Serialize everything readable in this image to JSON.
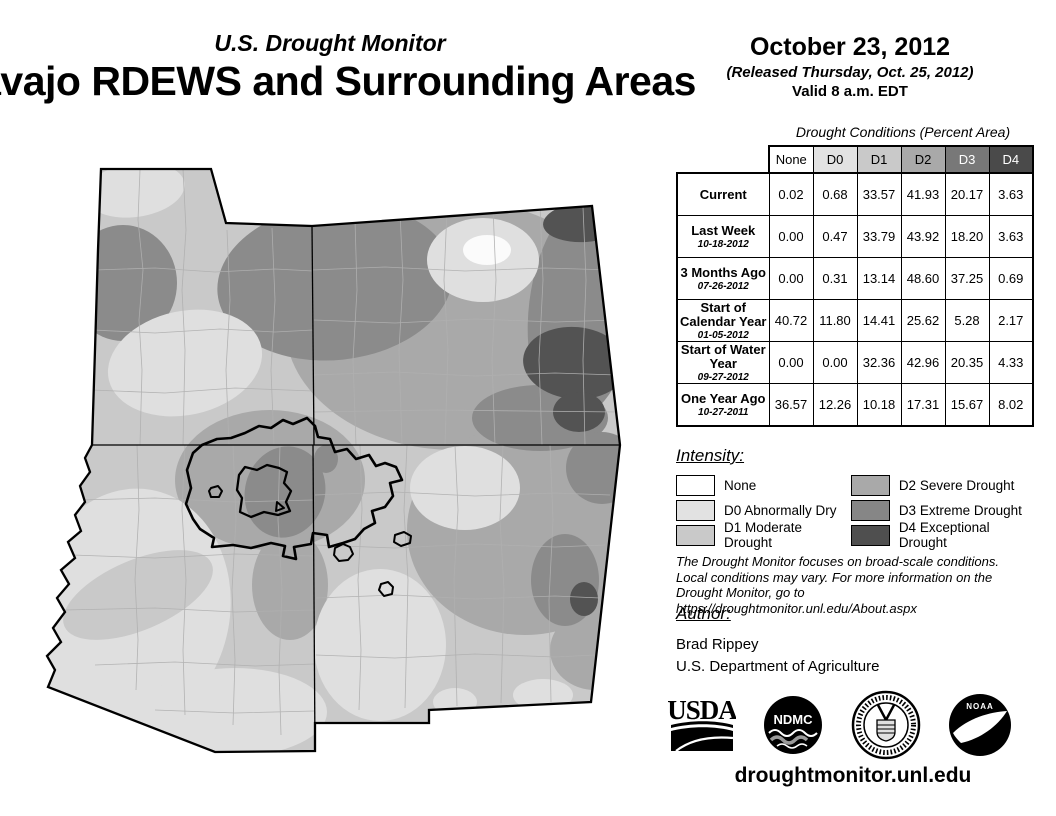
{
  "header": {
    "program": "U.S. Drought Monitor",
    "region_title": "Navajo RDEWS and Surrounding Areas",
    "date": "October 23, 2012",
    "released": "(Released Thursday, Oct. 25, 2012)",
    "valid": "Valid 8 a.m. EDT"
  },
  "table": {
    "title": "Drought Conditions (Percent Area)",
    "columns": [
      "None",
      "D0",
      "D1",
      "D2",
      "D3",
      "D4"
    ],
    "column_colors": {
      "None": "#ffffff",
      "D0": "#e2e2e2",
      "D1": "#c9c9c9",
      "D2": "#a9a9a9",
      "D3": "#787878",
      "D4": "#4a4a4a"
    },
    "rows": [
      {
        "label": "Current",
        "sublabel": "",
        "values": [
          "0.02",
          "0.68",
          "33.57",
          "41.93",
          "20.17",
          "3.63"
        ]
      },
      {
        "label": "Last Week",
        "sublabel": "10-18-2012",
        "values": [
          "0.00",
          "0.47",
          "33.79",
          "43.92",
          "18.20",
          "3.63"
        ]
      },
      {
        "label": "3 Months Ago",
        "sublabel": "07-26-2012",
        "values": [
          "0.00",
          "0.31",
          "13.14",
          "48.60",
          "37.25",
          "0.69"
        ]
      },
      {
        "label": "Start of Calendar Year",
        "sublabel": "01-05-2012",
        "values": [
          "40.72",
          "11.80",
          "14.41",
          "25.62",
          "5.28",
          "2.17"
        ]
      },
      {
        "label": "Start of Water Year",
        "sublabel": "09-27-2012",
        "values": [
          "0.00",
          "0.00",
          "32.36",
          "42.96",
          "20.35",
          "4.33"
        ]
      },
      {
        "label": "One Year Ago",
        "sublabel": "10-27-2011",
        "values": [
          "36.57",
          "12.26",
          "10.18",
          "17.31",
          "15.67",
          "8.02"
        ]
      }
    ]
  },
  "legend": {
    "title": "Intensity:",
    "items": [
      {
        "label": "None",
        "color": "#ffffff"
      },
      {
        "label": "D0 Abnormally Dry",
        "color": "#e2e2e2"
      },
      {
        "label": "D1 Moderate Drought",
        "color": "#c9c9c9"
      },
      {
        "label": "D2 Severe Drought",
        "color": "#a9a9a9"
      },
      {
        "label": "D3 Extreme Drought",
        "color": "#868686"
      },
      {
        "label": "D4 Exceptional Drought",
        "color": "#4f4f4f"
      }
    ]
  },
  "disclaimer": {
    "lines": [
      "The Drought Monitor focuses on broad-scale conditions.",
      "Local conditions may vary. For more information on the",
      "Drought Monitor, go to https://droughtmonitor.unl.edu/About.aspx"
    ]
  },
  "author": {
    "title": "Author:",
    "name": "Brad Rippey",
    "org": "U.S. Department of Agriculture"
  },
  "logos": {
    "usda": "USDA",
    "ndmc": "NDMC",
    "noaa": "NOAA"
  },
  "footer": {
    "url": "droughtmonitor.unl.edu"
  }
}
